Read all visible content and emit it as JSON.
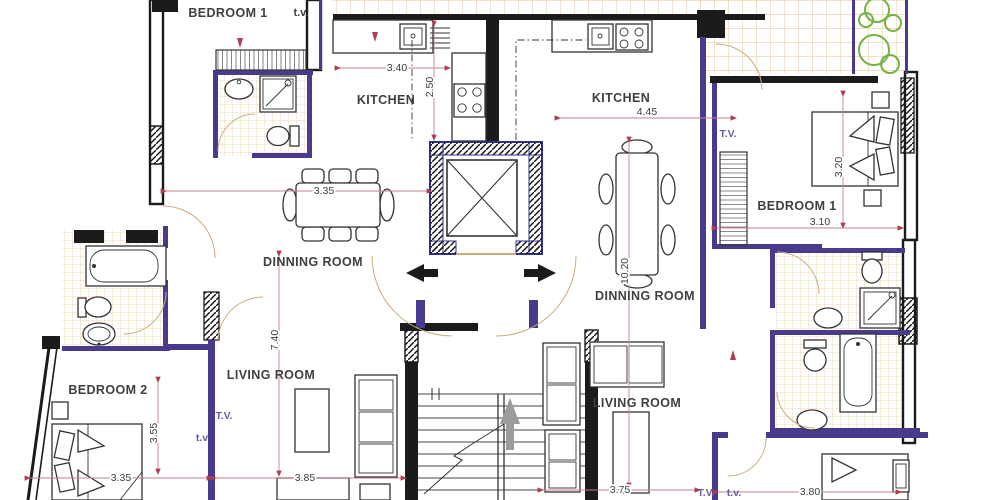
{
  "plan": {
    "type": "architectural-floor-plan",
    "labels": {
      "bedroom1_top": "BEDROOM 1",
      "tv_top": "t.v.",
      "kitchen_left": "KITCHEN",
      "kitchen_right": "KITCHEN",
      "dinning_left": "DINNING ROOM",
      "dinning_right": "DINNING ROOM",
      "living_left": "LIVING ROOM",
      "living_right": "LIVING  ROOM",
      "bedroom2": "BEDROOM 2",
      "bedroom1_right": "BEDROOM 1",
      "tv_right_top": "T.V.",
      "tv_left_1": "T.V.",
      "tv_left_2": "t.v",
      "tv_bottom_1": "T.V.",
      "tv_bottom_2": "t.v."
    },
    "dims": {
      "kitchen_left_w": "3.40",
      "kitchen_left_d": "2.50",
      "kitchen_right_w": "4.45",
      "dinning_left_w": "3.35",
      "unit_left_h": "7.40",
      "unit_right_h": "10.20",
      "bedroom1_right_h": "3.20",
      "bedroom1_right_w": "3.10",
      "bedroom2_h": "3.55",
      "bedroom2_w": "3.35",
      "living_left_w": "3.85",
      "living_right_w": "3.75",
      "bedroom_br_w": "3.80"
    },
    "colors": {
      "wall": "#1b1b1b",
      "partition": "#4a3a8e",
      "elevator_border": "#2f2f8f",
      "tile": "#eacfa5",
      "tree": "#74b343",
      "dimension": "#b23b50",
      "tv_text": "#6b5ba6"
    }
  }
}
